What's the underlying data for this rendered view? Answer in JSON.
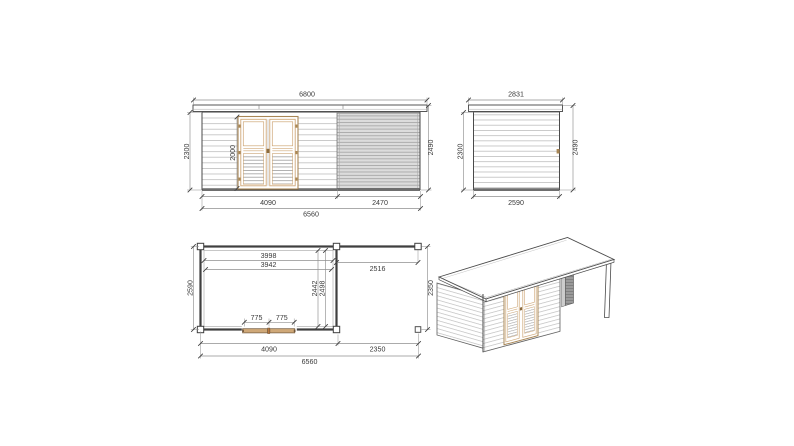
{
  "page": {
    "background": "#ffffff"
  },
  "colors": {
    "page_bg": "#ffffff",
    "line_dark": "#3f3f3f",
    "dim_line": "#8f8f8f",
    "dim_text": "#3a3a3a",
    "siding_line": "#b5b5b5",
    "canopy_fill": "#dcdcdc",
    "canopy_line": "#9e9e9e",
    "wood": "#cfa878",
    "wood_dark": "#a98756",
    "hardware": "#b9773c",
    "slat_fill": "#9a9a9a"
  },
  "views": {
    "front_elevation": {
      "dims": {
        "overall_width": "6800",
        "wall_height": "2300",
        "door_height": "2000",
        "overall_height": "2490",
        "cabin_width": "4090",
        "canopy_width": "2470",
        "total_width": "6560"
      }
    },
    "side_elevation": {
      "dims": {
        "roof_depth": "2831",
        "wall_height": "2300",
        "overall_height": "2490",
        "base_depth": "2590"
      }
    },
    "floor_plan": {
      "dims": {
        "interior_width_a": "3998",
        "interior_width_b": "3942",
        "canopy_opening": "2516",
        "side_depth": "2590",
        "interior_depth_a": "2442",
        "interior_depth_b": "2498",
        "canopy_depth": "2350",
        "door_leaf_left": "775",
        "door_leaf_right": "775",
        "cabin_width": "4090",
        "canopy_width": "2350",
        "total_width": "6560"
      }
    }
  }
}
